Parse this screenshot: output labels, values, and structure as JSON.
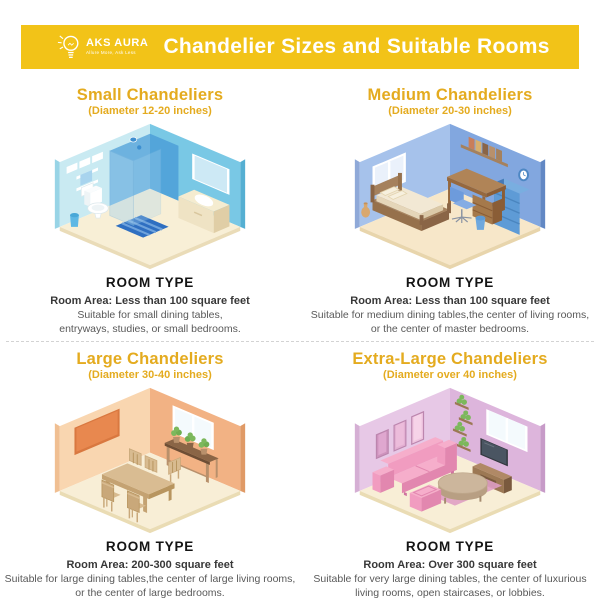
{
  "header": {
    "brand_name": "AKS AURA",
    "brand_tagline": "Allure More, Ask Less",
    "title": "Chandelier Sizes and Suitable Rooms"
  },
  "labels": {
    "room_type": "ROOM TYPE"
  },
  "sections": [
    {
      "title": "Small Chandeliers",
      "subtitle": "(Diameter 12-20 inches)",
      "room": "bathroom",
      "room_area": "Room Area: Less than 100 square feet",
      "description": "Suitable for small dining tables,\nentryways, studies, or small bedrooms."
    },
    {
      "title": "Medium Chandeliers",
      "subtitle": "(Diameter 20-30 inches)",
      "room": "bedroom",
      "room_area": "Room Area: Less than 100 square feet",
      "description": "Suitable for medium dining tables,the center of living rooms,\nor the center of master bedrooms."
    },
    {
      "title": "Large Chandeliers",
      "subtitle": "(Diameter 30-40 inches)",
      "room": "dining room",
      "room_area": "Room Area: 200-300 square feet",
      "description": "Suitable for large dining tables,the center of large living rooms,\nor the center of large bedrooms."
    },
    {
      "title": "Extra-Large Chandeliers",
      "subtitle": "(Diameter over 40 inches)",
      "room": "living room",
      "room_area": "Room Area: Over 300 square feet",
      "description": "Suitable for very large dining tables, the center of luxurious\nliving rooms, open staircases, or lobbies."
    }
  ],
  "colors": {
    "banner": "#F2C318",
    "gold": "#E4AB1F",
    "title-text": "#FFFFFF",
    "room-type-text": "#141414",
    "area-text": "#383838",
    "desc-text": "#595959",
    "divider": "#D3D3D3",
    "bath-wall-l": "#C9EAF2",
    "bath-wall-r": "#79C8E5",
    "bath-edge-l": "#98D4E6",
    "bath-edge-r": "#55AFD2",
    "bath-floor": "#F8EFD6",
    "bath-floor-edge": "#EADCB8",
    "bath-glass": "#4D9FD8",
    "bath-glass-front": "#A8D4EE",
    "bath-head": "#3D8FD0",
    "bath-mat": "#2F6FC1",
    "bath-mat-stripe": "#6FA3DC",
    "bath-fixture": "#FFFFFF",
    "bath-fixture-shade": "#EEF4F6",
    "bath-fixture-stroke": "#DCE8EC",
    "bath-vanity-top": "#F5ECD0",
    "bath-vanity-front": "#EFE3C4",
    "bath-vanity-side": "#E0CEA6",
    "bath-vanity-line": "#D9C79E",
    "bath-mirror": "#CDE9F5",
    "bath-bin": "#5FB8E4",
    "bath-bin-dark": "#49A8D8",
    "bed-wall-l": "#A6C2EB",
    "bed-wall-r": "#82A7DF",
    "bed-edge-l": "#8FA9D8",
    "bed-edge-r": "#6288C4",
    "bed-floor": "#F7E7C9",
    "bed-floor-edge": "#E8D5AC",
    "bed-wood": "#A5815D",
    "bed-wood-mid": "#96714C",
    "bed-wood-dark": "#8A6546",
    "bed-mattress": "#F2E8D4",
    "bed-mattress-side": "#E5D6B9",
    "bed-mattress-foot": "#DBC9A8",
    "bed-pillow": "#F7F0DE",
    "bed-pillow-line": "#E3D4AF",
    "bed-desk": "#B08457",
    "bed-desk-front": "#96683E",
    "bed-desk-side": "#8A5D36",
    "bed-drawer": "#A5794B",
    "bed-chair": "#85ACE4",
    "bed-chair-dark": "#6D9BDC",
    "bed-chair-metal": "#8A93A3",
    "bed-case": "#5E9BD6",
    "bed-case-side": "#4679B5",
    "bed-case-top": "#79AEE0",
    "bed-case-line": "#4A85BF",
    "bed-bucket": "#6FA8DE",
    "bed-bucket-dark": "#5E9BD6",
    "bed-vase": "#D9A86E",
    "bed-vase-dark": "#C4915A",
    "bed-window-pane": "#EAF1FB",
    "bed-clock": "#4D87C4",
    "bed-book-1": "#C97E5A",
    "bed-book-2": "#D9B06C",
    "bed-book-3": "#8A6546",
    "bed-book-4": "#B8906B",
    "bed-book-5": "#A5815D",
    "din-wall-l": "#F9D6B0",
    "din-wall-r": "#F2B284",
    "din-edge-l": "#F0BF92",
    "din-edge-r": "#E09A66",
    "din-floor": "#F8EED6",
    "din-floor-edge": "#EADCB4",
    "din-board": "#E8884F",
    "din-board-frame": "#D97840",
    "din-window-pane": "#F4FAFD",
    "din-console": "#8A6546",
    "din-console-dark": "#6E4E35",
    "din-console-leg": "#B8906B",
    "din-plant": "#7CB85C",
    "din-plant-dark": "#6FAE51",
    "din-pot": "#B8906B",
    "din-pot-dark": "#8A6546",
    "din-table": "#D9BC92",
    "din-table-front": "#C4A272",
    "din-table-side": "#B8955F",
    "din-chair": "#D8BB90",
    "din-chair-dark": "#C9A87A",
    "din-chair-line": "#B8955F",
    "liv-wall-l": "#E7C8E6",
    "liv-wall-r": "#DDB5DC",
    "liv-edge-l": "#D5AFD4",
    "liv-edge-r": "#C79BC8",
    "liv-floor": "#F8EED6",
    "liv-floor-edge": "#EADCB4",
    "liv-frame-1": "#CE93BD",
    "liv-frame-1i": "#DFA7CF",
    "liv-frame-2": "#E3AFD2",
    "liv-frame-2i": "#ECBCDB",
    "liv-frame-3": "#EFC4DF",
    "liv-frame-3i": "#F6D3E8",
    "liv-frame-stroke": "#BC86AE",
    "liv-shelf": "#9C7854",
    "liv-plant": "#7CB85C",
    "liv-window-pane": "#F4FAFD",
    "liv-tv": "#33383F",
    "liv-tv-screen": "#4A5562",
    "liv-tv-line": "#6B7480",
    "liv-stand": "#9C7854",
    "liv-stand-top": "#B08966",
    "liv-stand-arch": "#7A5A3E",
    "liv-sofa": "#F19CC0",
    "liv-sofa-light": "#F6AECB",
    "liv-sofa-mid": "#E287AF",
    "liv-sofa-dark": "#D073A0",
    "liv-rug": "#DF9FC4",
    "liv-ctable": "#CCB69C",
    "liv-ctable-side": "#B89F83",
    "liv-ctable-base": "#A58B6F"
  }
}
